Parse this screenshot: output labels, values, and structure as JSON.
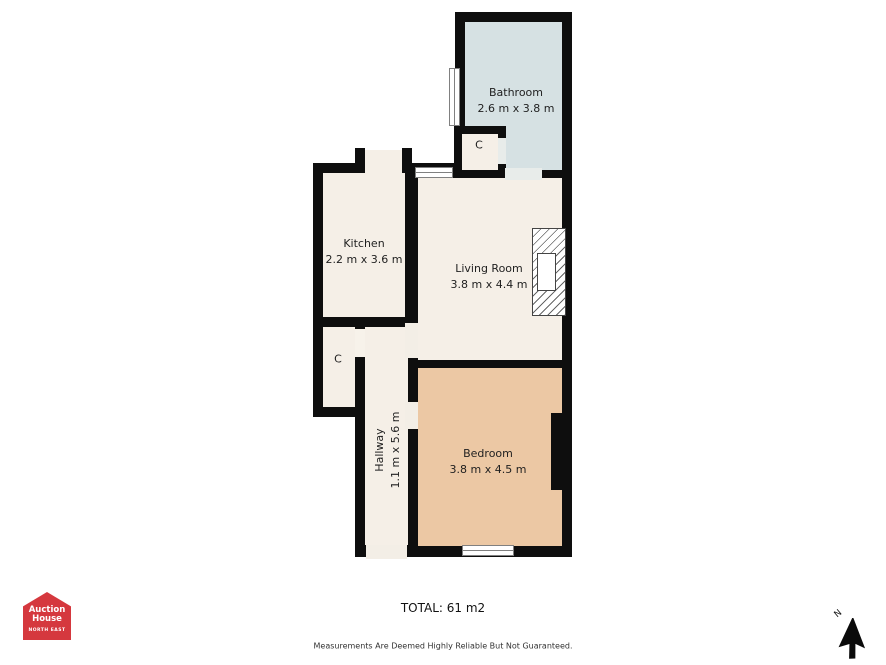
{
  "plan": {
    "rooms": {
      "bathroom": {
        "name": "Bathroom",
        "dims": "2.6 m x 3.8 m"
      },
      "kitchen": {
        "name": "Kitchen",
        "dims": "2.2 m x 3.6 m"
      },
      "living_room": {
        "name": "Living Room",
        "dims": "3.8 m x 4.4 m"
      },
      "bedroom": {
        "name": "Bedroom",
        "dims": "3.8 m x 4.5 m"
      },
      "hallway": {
        "name": "Hallway",
        "dims": "1.1 m x 5.6 m"
      }
    },
    "closets": {
      "bathroom_closet": {
        "label": "C"
      },
      "hallway_closet": {
        "label": "C"
      }
    }
  },
  "footer": {
    "total": "TOTAL: 61 m2",
    "disclaimer": "Measurements Are Deemed Highly Reliable But Not Guaranteed."
  },
  "logo": {
    "line1": "Auction",
    "line2": "House",
    "region": "NORTH EAST"
  },
  "compass": {
    "label": "N"
  },
  "colors": {
    "wall": "#0e0e0e",
    "bathroom-fill": "#d6e1e3",
    "room-fill": "#f5efe7",
    "bedroom-fill": "#ecc8a4",
    "door-gap": "#f3eee6",
    "light-gap": "#f7f2ea",
    "bath-door-gap": "#e8ecea",
    "logo-red": "#d5383e",
    "label-text": "#1f1f1f",
    "window-frame": "#808080"
  }
}
